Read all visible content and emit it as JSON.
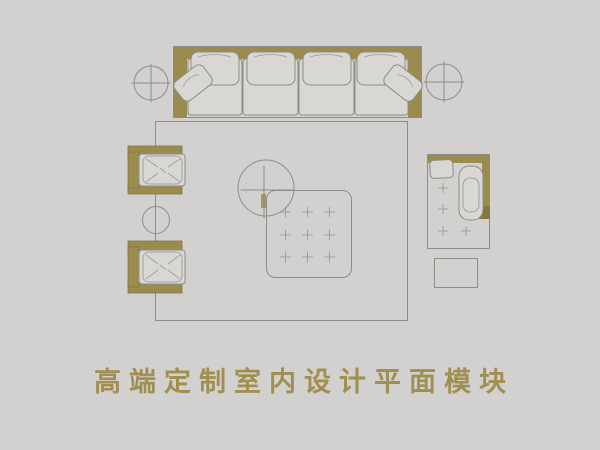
{
  "title": {
    "text": "高端定制室内设计平面模块"
  },
  "colors": {
    "background": "#d3d1cf",
    "accent": "#9a8b4e",
    "accent_dark": "#867640",
    "line": "#8d8c88",
    "cushion": "#d9d7d4",
    "title_text": "#a18f51"
  },
  "scene": {
    "items": [
      "four-seat-sofa",
      "crosshair-side-table-left",
      "crosshair-side-table-right",
      "area-rug",
      "round-coffee-table",
      "tufted-ottoman",
      "armchair-upper",
      "armchair-lower",
      "round-accent-table",
      "chaise-lounge-chair",
      "side-stool"
    ]
  }
}
